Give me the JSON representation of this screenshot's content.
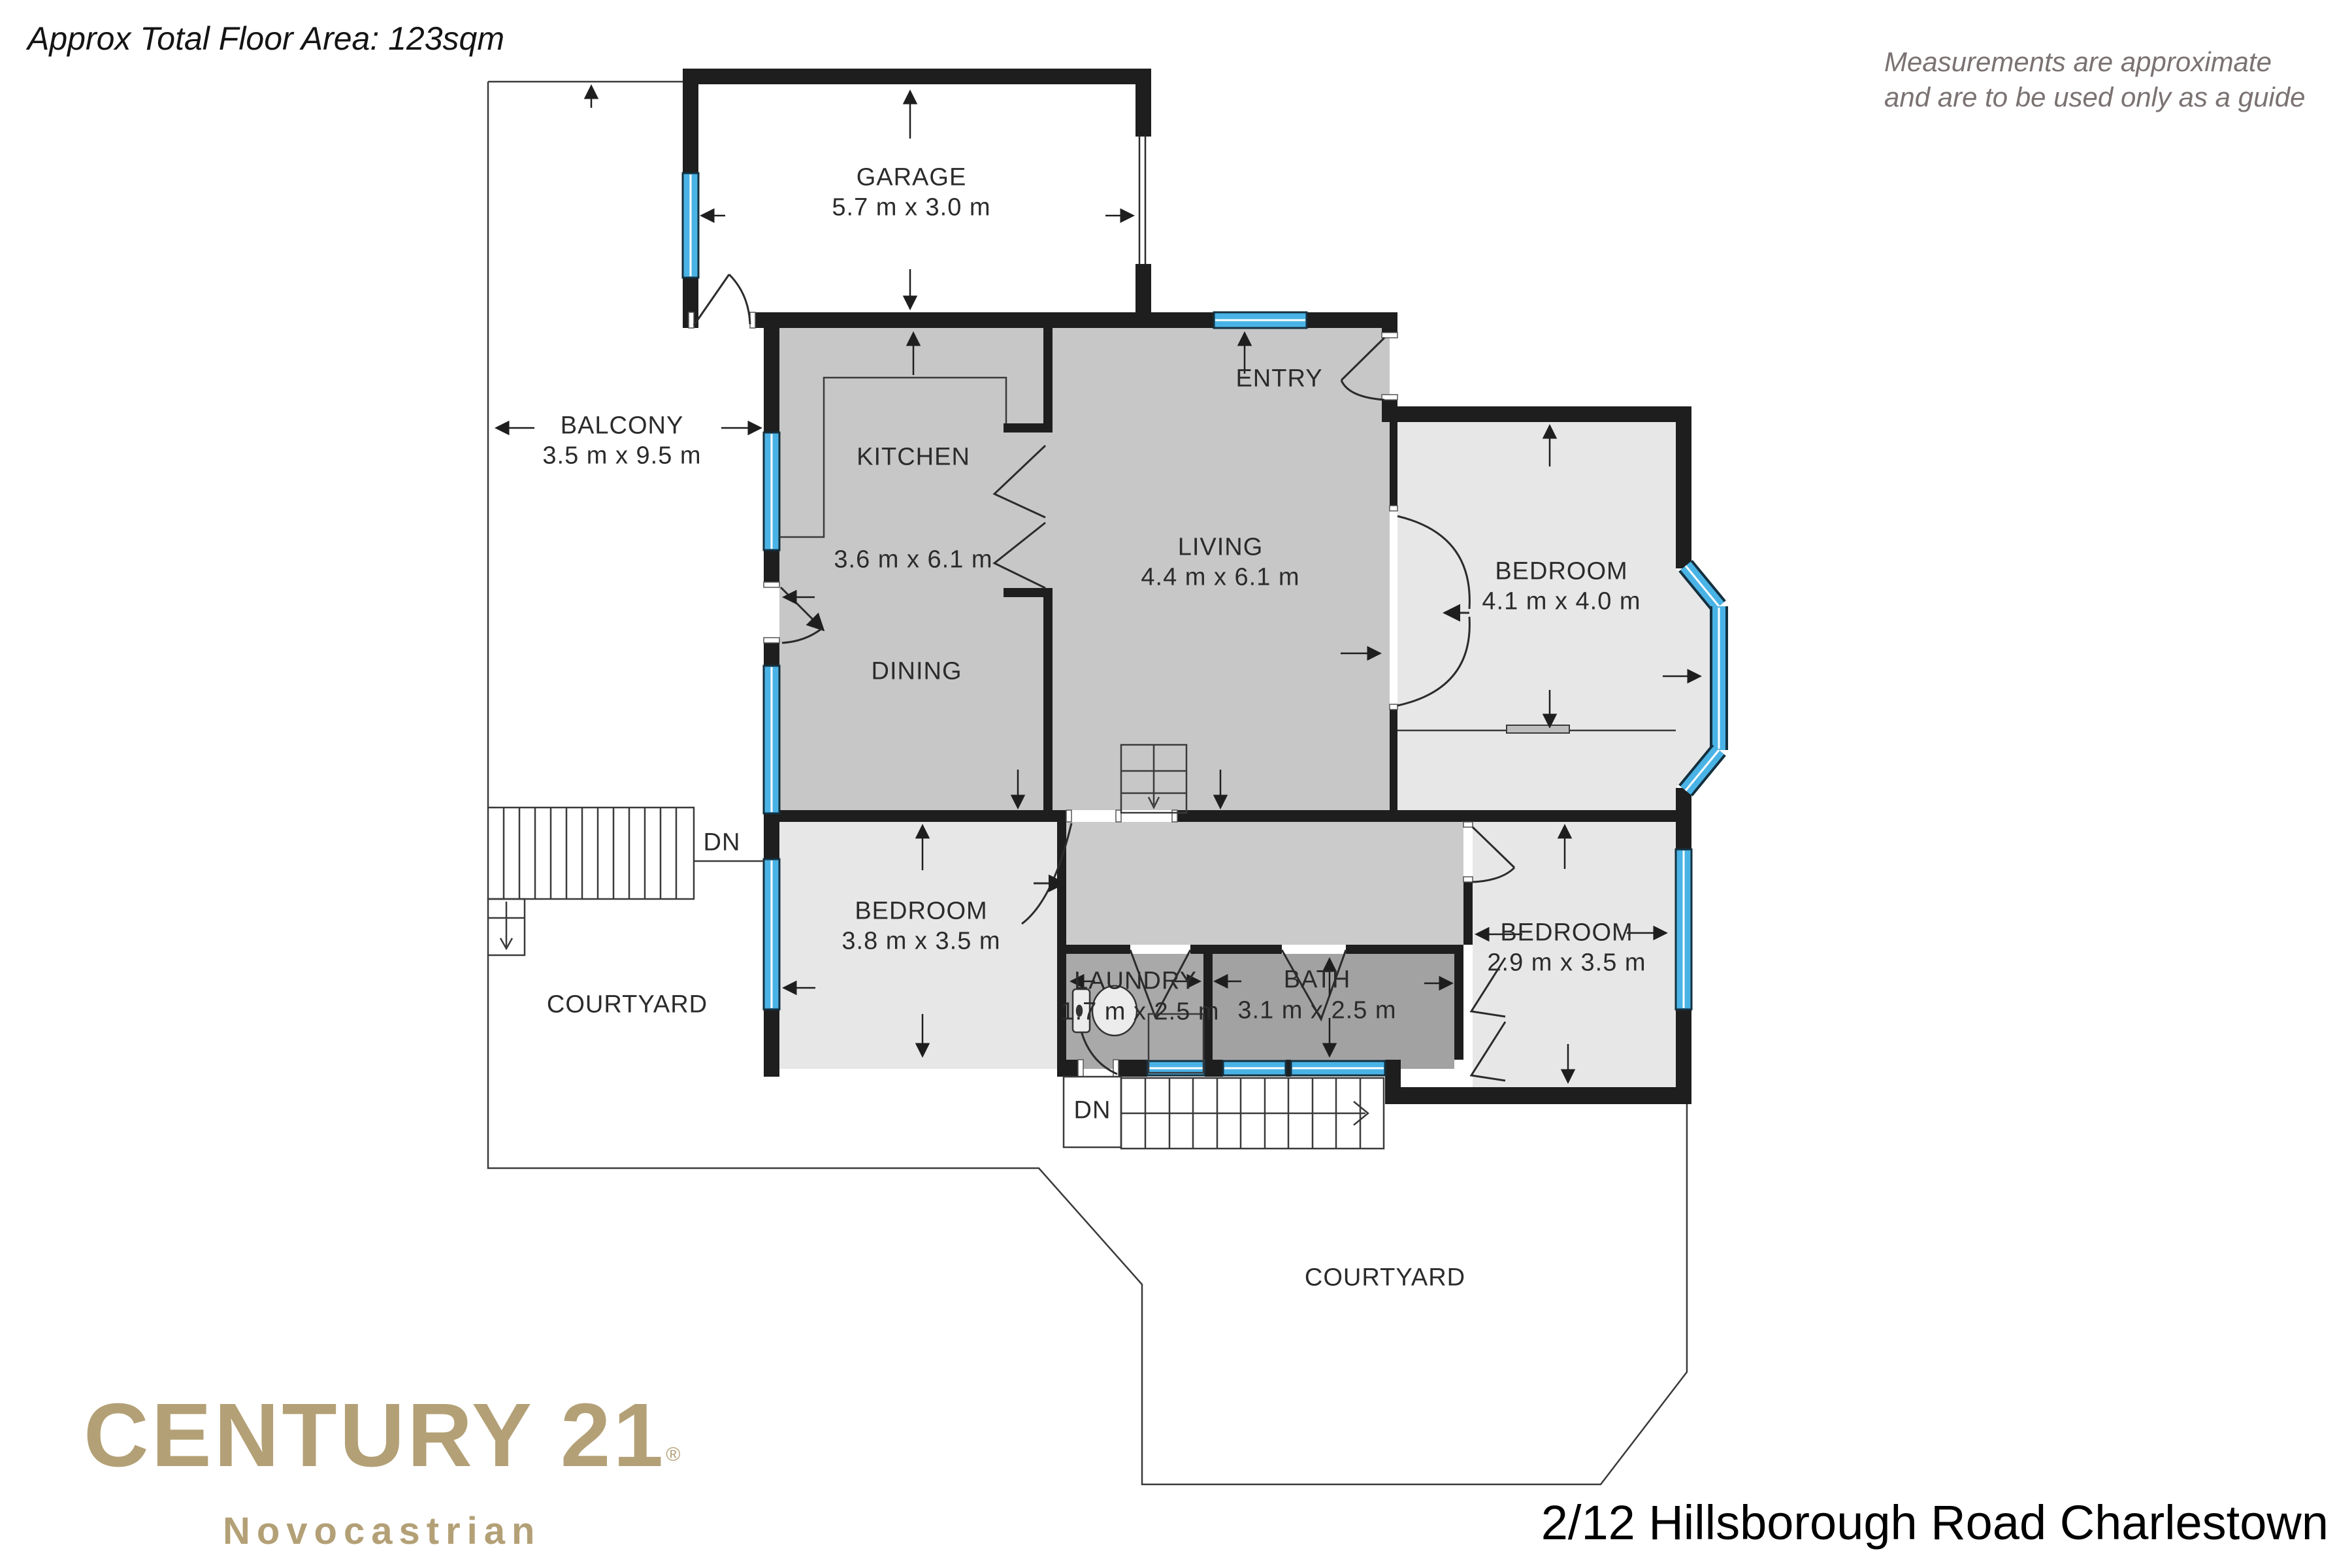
{
  "title": "Approx Total Floor Area: 123sqm",
  "disclaimer": {
    "line1": "Measurements are approximate",
    "line2": "and are to be used only as a guide"
  },
  "rooms": {
    "garage": {
      "name": "GARAGE",
      "dims": "5.7 m x 3.0 m"
    },
    "balcony": {
      "name": "BALCONY",
      "dims": "3.5 m x 9.5 m"
    },
    "kitchen": {
      "name": "KITCHEN"
    },
    "kitchen_dining_dims": "3.6 m x 6.1 m",
    "dining": {
      "name": "DINING"
    },
    "living": {
      "name": "LIVING",
      "dims": "4.4 m x 6.1 m"
    },
    "entry": {
      "name": "ENTRY"
    },
    "bedroom_top_right": {
      "name": "BEDROOM",
      "dims": "4.1 m x 4.0 m"
    },
    "bedroom_bottom_left": {
      "name": "BEDROOM",
      "dims": "3.8 m x 3.5 m"
    },
    "bedroom_bottom_right": {
      "name": "BEDROOM",
      "dims": "2.9 m x 3.5 m"
    },
    "laundry": {
      "name": "LAUNDRY",
      "dims": "1.7 m x 2.5 m"
    },
    "bath": {
      "name": "BATH",
      "dims": "3.1 m x 2.5 m"
    },
    "courtyard_left": {
      "name": "COURTYARD"
    },
    "courtyard_bottom": {
      "name": "COURTYARD"
    }
  },
  "stairs": {
    "down_label_left": "DN",
    "down_label_bottom": "DN"
  },
  "branding": {
    "brand": "CENTURY 21",
    "registered": "®",
    "office": "Novocastrian"
  },
  "address": "2/12 Hillsborough Road Charlestown",
  "colors": {
    "wall": "#1e1e1e",
    "window_blue": "#4ab3e6",
    "floor_main": "#c7c7c7",
    "floor_bedroom": "#e7e7e7",
    "floor_hall": "#cbcbcb",
    "floor_laundry": "#a9a9a9",
    "floor_bath": "#a2a2a2",
    "brand_gold": "#b3a076",
    "disclaimer_gray": "#7b7272"
  }
}
